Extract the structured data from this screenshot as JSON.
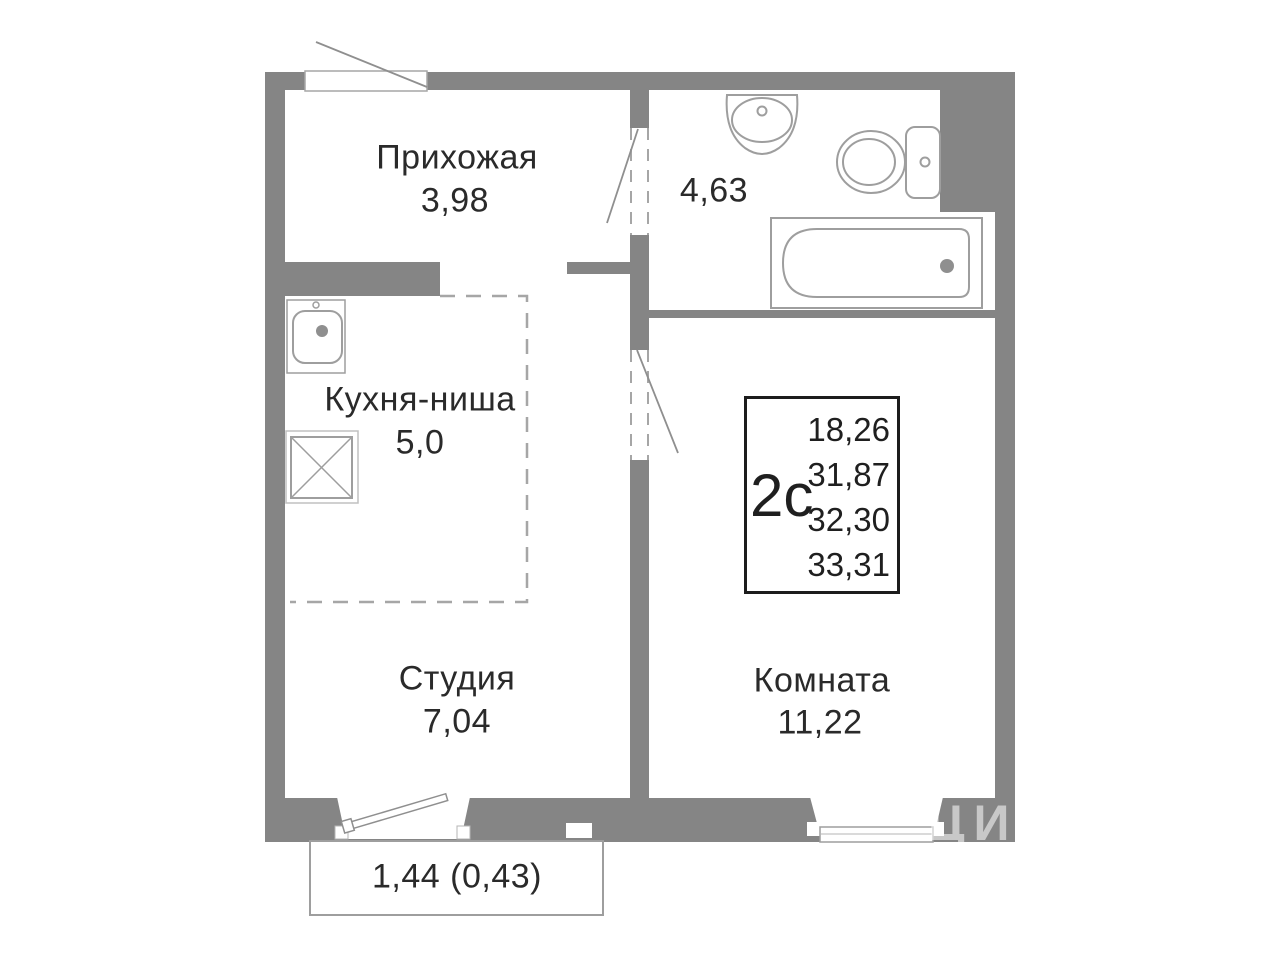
{
  "rooms": {
    "hallway": {
      "label": "Прихожая",
      "area": "3,98"
    },
    "bathroom": {
      "area": "4,63"
    },
    "kitchen": {
      "label": "Кухня-ниша",
      "area": "5,0"
    },
    "studio": {
      "label": "Студия",
      "area": "7,04"
    },
    "room": {
      "label": "Комната",
      "area": "11,22"
    }
  },
  "balcony": {
    "label": "1,44 (0,43)"
  },
  "unit_card": {
    "type": "2с",
    "areas": [
      "18,26",
      "31,87",
      "32,30",
      "33,31"
    ]
  },
  "watermark": "ЦИАН",
  "colors": {
    "wall": "#858585",
    "fixture_outline": "#9e9e9e",
    "dash": "#a6a6a6",
    "text": "#2a2a2a",
    "unit_border": "#1c1c1c",
    "background": "#ffffff"
  },
  "fixtures": [
    "wash-basin",
    "toilet",
    "bathtub",
    "kitchen-sink",
    "stove",
    "entrance-door",
    "bathroom-door",
    "room-door",
    "balcony-door",
    "window"
  ]
}
